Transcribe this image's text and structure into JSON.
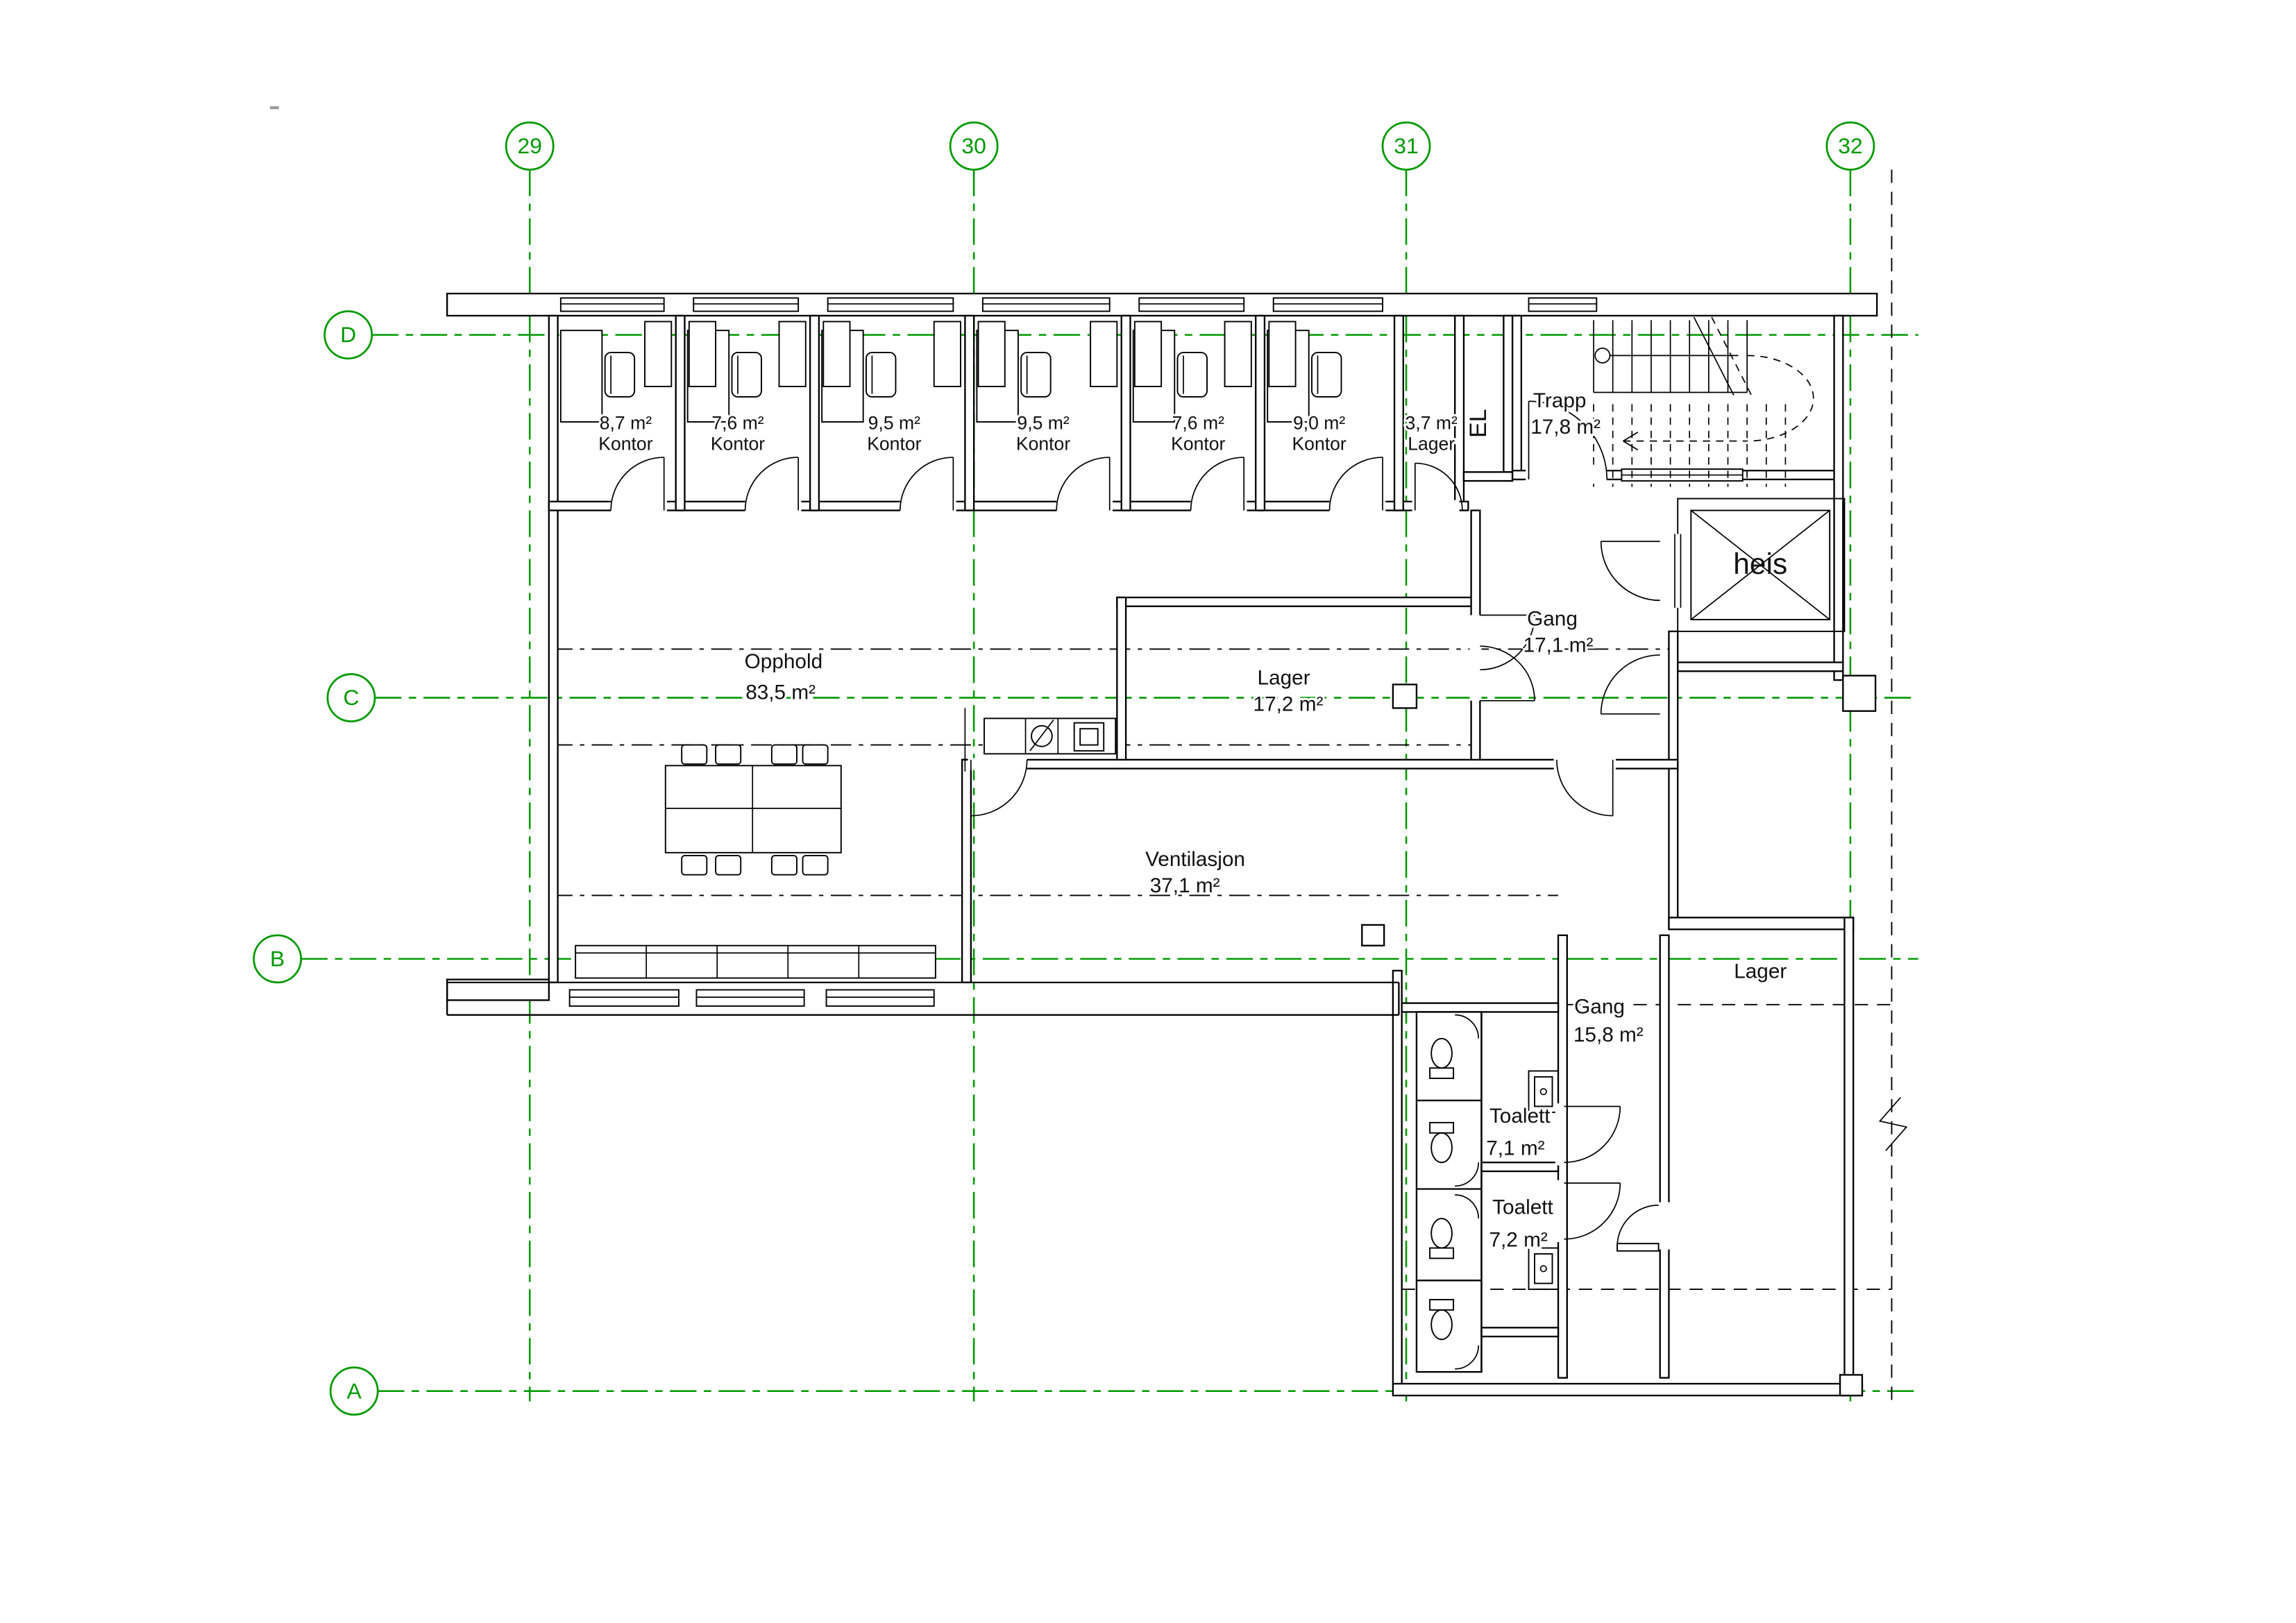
{
  "page": {
    "background": "#ffffff",
    "line_color": "#000000",
    "grid_color": "#009900"
  },
  "grid": {
    "columns": [
      "29",
      "30",
      "31",
      "32"
    ],
    "rows": [
      "D",
      "C",
      "B",
      "A"
    ]
  },
  "rooms": {
    "kontor_1": {
      "area": "8,7 m²",
      "name": "Kontor"
    },
    "kontor_2": {
      "area": "7,6 m²",
      "name": "Kontor"
    },
    "kontor_3": {
      "area": "9,5 m²",
      "name": "Kontor"
    },
    "kontor_4": {
      "area": "9,5 m²",
      "name": "Kontor"
    },
    "kontor_5": {
      "area": "7,6 m²",
      "name": "Kontor"
    },
    "kontor_6": {
      "area": "9,0 m²",
      "name": "Kontor"
    },
    "lager_liten": {
      "area": "3,7 m²",
      "name": "Lager"
    },
    "el": {
      "name": "EL"
    },
    "trapp": {
      "name": "Trapp",
      "area": "17,8 m²"
    },
    "heis": {
      "name": "heis"
    },
    "gang_oevre": {
      "name": "Gang",
      "area": "17,1 m²"
    },
    "opphold": {
      "name": "Opphold",
      "area": "83,5 m²"
    },
    "lager_midt": {
      "name": "Lager",
      "area": "17,2 m²"
    },
    "ventilasjon": {
      "name": "Ventilasjon",
      "area": "37,1 m²"
    },
    "gang_nedre": {
      "name": "Gang",
      "area": "15,8 m²"
    },
    "lager_soer": {
      "name": "Lager"
    },
    "toalett_1": {
      "name": "Toalett",
      "area": "7,1 m²"
    },
    "toalett_2": {
      "name": "Toalett",
      "area": "7,2 m²"
    }
  }
}
